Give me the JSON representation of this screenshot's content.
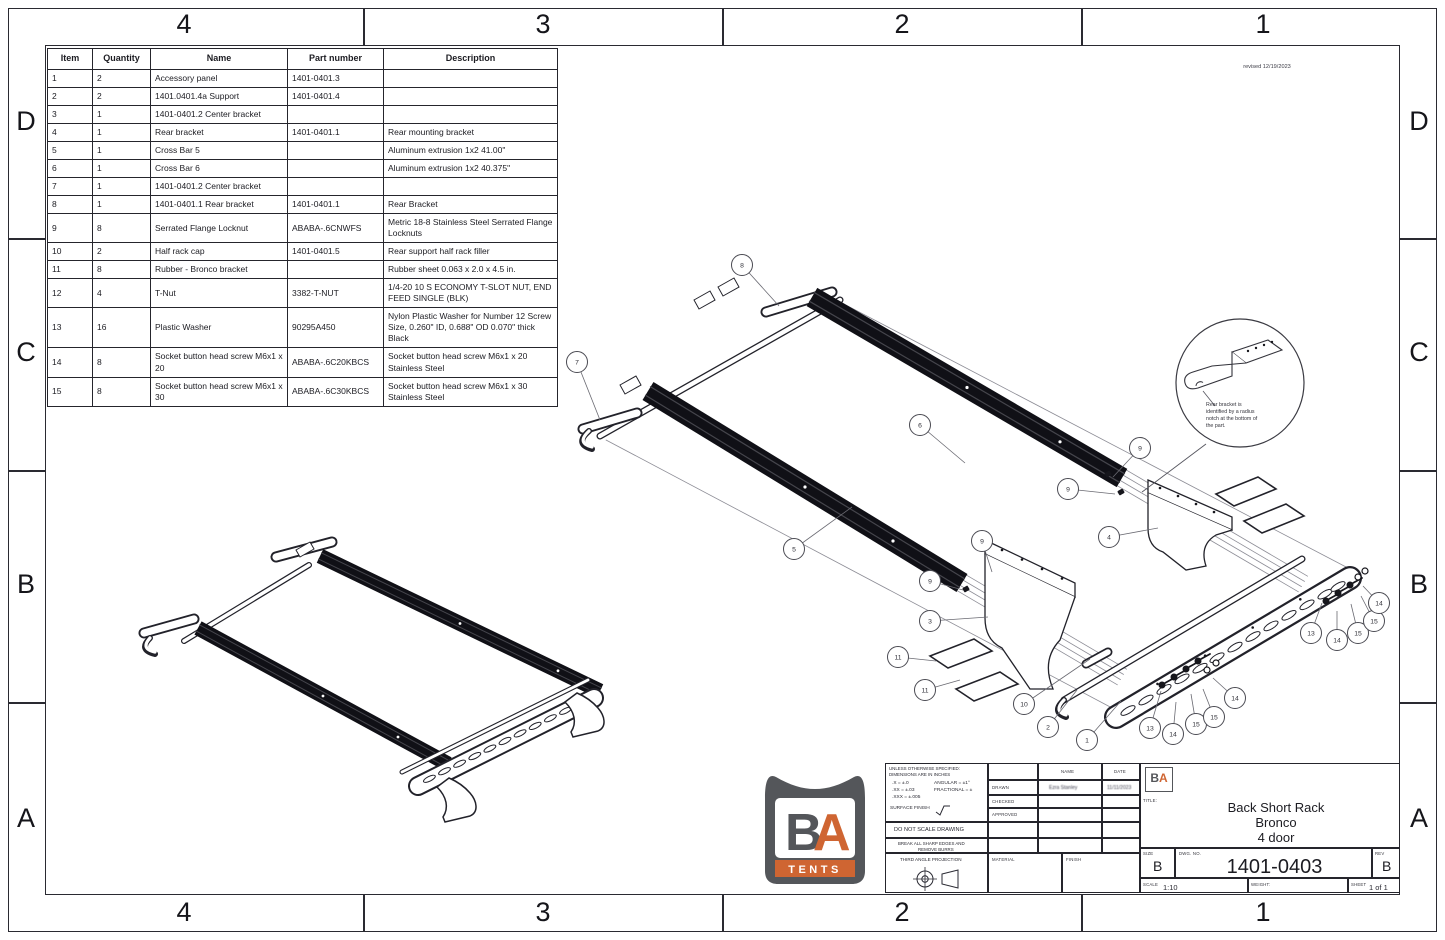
{
  "border": {
    "cols": [
      "4",
      "3",
      "2",
      "1"
    ],
    "rows": [
      "D",
      "C",
      "B",
      "A"
    ]
  },
  "revision_note": "revised 12/19/2023",
  "bom": {
    "headers": [
      "Item",
      "Quantity",
      "Name",
      "Part number",
      "Description"
    ],
    "rows": [
      {
        "item": "1",
        "qty": "2",
        "name": "Accessory panel",
        "part": "1401-0401.3",
        "desc": ""
      },
      {
        "item": "2",
        "qty": "2",
        "name": "1401.0401.4a Support",
        "part": "1401-0401.4",
        "desc": ""
      },
      {
        "item": "3",
        "qty": "1",
        "name": "1401-0401.2 Center bracket",
        "part": "",
        "desc": ""
      },
      {
        "item": "4",
        "qty": "1",
        "name": "Rear bracket",
        "part": "1401-0401.1",
        "desc": "Rear mounting bracket"
      },
      {
        "item": "5",
        "qty": "1",
        "name": "Cross Bar 5",
        "part": "",
        "desc": "Aluminum extrusion 1x2 41.00\""
      },
      {
        "item": "6",
        "qty": "1",
        "name": "Cross Bar 6",
        "part": "",
        "desc": "Aluminum extrusion 1x2 40.375\""
      },
      {
        "item": "7",
        "qty": "1",
        "name": "1401-0401.2 Center bracket",
        "part": "",
        "desc": ""
      },
      {
        "item": "8",
        "qty": "1",
        "name": "1401-0401.1 Rear bracket",
        "part": "1401-0401.1",
        "desc": "Rear Bracket"
      },
      {
        "item": "9",
        "qty": "8",
        "name": "Serrated Flange Locknut",
        "part": "ABABA-.6CNWFS",
        "desc": "Metric 18-8 Stainless Steel Serrated Flange Locknuts"
      },
      {
        "item": "10",
        "qty": "2",
        "name": "Half rack cap",
        "part": "1401-0401.5",
        "desc": "Rear support half rack filler"
      },
      {
        "item": "11",
        "qty": "8",
        "name": "Rubber - Bronco bracket",
        "part": "",
        "desc": "Rubber sheet 0.063 x 2.0 x 4.5 in."
      },
      {
        "item": "12",
        "qty": "4",
        "name": "T-Nut",
        "part": "3382-T-NUT",
        "desc": "1/4-20 10 S ECONOMY T-SLOT NUT, END FEED SINGLE (BLK)"
      },
      {
        "item": "13",
        "qty": "16",
        "name": "Plastic Washer",
        "part": "90295A450",
        "desc": "Nylon Plastic Washer for Number 12 Screw Size, 0.260\" ID, 0.688\" OD 0.070\" thick Black"
      },
      {
        "item": "14",
        "qty": "8",
        "name": "Socket button head screw M6x1 x 20",
        "part": "ABABA-.6C20KBCS",
        "desc": "Socket button head screw M6x1 x 20 Stainless Steel"
      },
      {
        "item": "15",
        "qty": "8",
        "name": "Socket button head screw M6x1 x 30",
        "part": "ABABA-.6C30KBCS",
        "desc": "Socket button head screw M6x1 x 30 Stainless Steel"
      }
    ]
  },
  "detail_callout": {
    "lines": [
      "Rear bracket is",
      "identified by a radius",
      "notch at the bottom of",
      "the part."
    ]
  },
  "balloons": [
    {
      "n": "8",
      "cx": 742,
      "cy": 265,
      "lx": 779,
      "ly": 306
    },
    {
      "n": "7",
      "cx": 577,
      "cy": 362,
      "lx": 600,
      "ly": 420
    },
    {
      "n": "6",
      "cx": 920,
      "cy": 425,
      "lx": 965,
      "ly": 463
    },
    {
      "n": "5",
      "cx": 794,
      "cy": 549,
      "lx": 852,
      "ly": 507
    },
    {
      "n": "9",
      "cx": 1140,
      "cy": 448,
      "lx": 1113,
      "ly": 477
    },
    {
      "n": "9",
      "cx": 1068,
      "cy": 489,
      "lx": 1115,
      "ly": 494
    },
    {
      "n": "4",
      "cx": 1109,
      "cy": 537,
      "lx": 1158,
      "ly": 528
    },
    {
      "n": "9",
      "cx": 982,
      "cy": 541,
      "lx": 992,
      "ly": 572
    },
    {
      "n": "9",
      "cx": 930,
      "cy": 581,
      "lx": 963,
      "ly": 590
    },
    {
      "n": "3",
      "cx": 930,
      "cy": 621,
      "lx": 988,
      "ly": 617
    },
    {
      "n": "11",
      "cx": 898,
      "cy": 657,
      "lx": 936,
      "ly": 661
    },
    {
      "n": "11",
      "cx": 925,
      "cy": 690,
      "lx": 960,
      "ly": 680
    },
    {
      "n": "10",
      "cx": 1024,
      "cy": 704,
      "lx": 1090,
      "ly": 659
    },
    {
      "n": "2",
      "cx": 1048,
      "cy": 727,
      "lx": 1077,
      "ly": 690
    },
    {
      "n": "1",
      "cx": 1087,
      "cy": 740,
      "lx": 1121,
      "ly": 701
    },
    {
      "n": "13",
      "cx": 1150,
      "cy": 728,
      "lx": 1161,
      "ly": 691
    },
    {
      "n": "14",
      "cx": 1173,
      "cy": 734,
      "lx": 1176,
      "ly": 702
    },
    {
      "n": "15",
      "cx": 1196,
      "cy": 724,
      "lx": 1191,
      "ly": 694
    },
    {
      "n": "15",
      "cx": 1214,
      "cy": 717,
      "lx": 1203,
      "ly": 689
    },
    {
      "n": "14",
      "cx": 1235,
      "cy": 698,
      "lx": 1213,
      "ly": 678
    },
    {
      "n": "13",
      "cx": 1311,
      "cy": 633,
      "lx": 1322,
      "ly": 603
    },
    {
      "n": "14",
      "cx": 1337,
      "cy": 640,
      "lx": 1337,
      "ly": 611
    },
    {
      "n": "15",
      "cx": 1358,
      "cy": 633,
      "lx": 1351,
      "ly": 604
    },
    {
      "n": "15",
      "cx": 1374,
      "cy": 621,
      "lx": 1361,
      "ly": 596
    },
    {
      "n": "14",
      "cx": 1379,
      "cy": 603,
      "lx": 1363,
      "ly": 586
    }
  ],
  "logo": {
    "b": "B",
    "a": "A",
    "tents": "TENTS",
    "gray": "#54565a",
    "orange": "#cf6532"
  },
  "title_block": {
    "spec_line1": "UNLESS OTHERWISE SPECIFIED:",
    "spec_line2": "DIMENSIONS ARE IN INCHES",
    "tol_line1": ".X = ±.0",
    "tol_line2": ".XX = ±.03",
    "tol_line3": ".XXX = ±.005",
    "tol_ang": "ANGULAR = ±1°",
    "tol_frac": "FRACTIONAL = ±",
    "surface_finish": "SURFACE FINISH",
    "do_not_scale": "DO NOT SCALE DRAWING",
    "break_edges_1": "BREAK ALL SHARP EDGES AND",
    "break_edges_2": "REMOVE BURRS",
    "projection": "THIRD ANGLE PROJECTION",
    "name_header": "NAME",
    "date_header": "DATE",
    "drawn_label": "DRAWN",
    "drawn_name": "Ezra Stanley",
    "drawn_date": "11/11/2023",
    "checked_label": "CHECKED",
    "approved_label": "APPROVED",
    "material_label": "MATERIAL",
    "finish_label": "FINISH",
    "title_label": "TITLE:",
    "title_lines": [
      "Back Short Rack",
      "Bronco",
      "4 door"
    ],
    "size_label": "SIZE",
    "size_value": "B",
    "dwg_label": "DWG. NO.",
    "dwg_value": "1401-0403",
    "rev_label": "REV",
    "rev_value": "B",
    "scale_label": "SCALE",
    "scale_value": "1:10",
    "weight_label": "WEIGHT:",
    "sheet_label": "SHEET",
    "sheet_value": "1 of 1"
  }
}
